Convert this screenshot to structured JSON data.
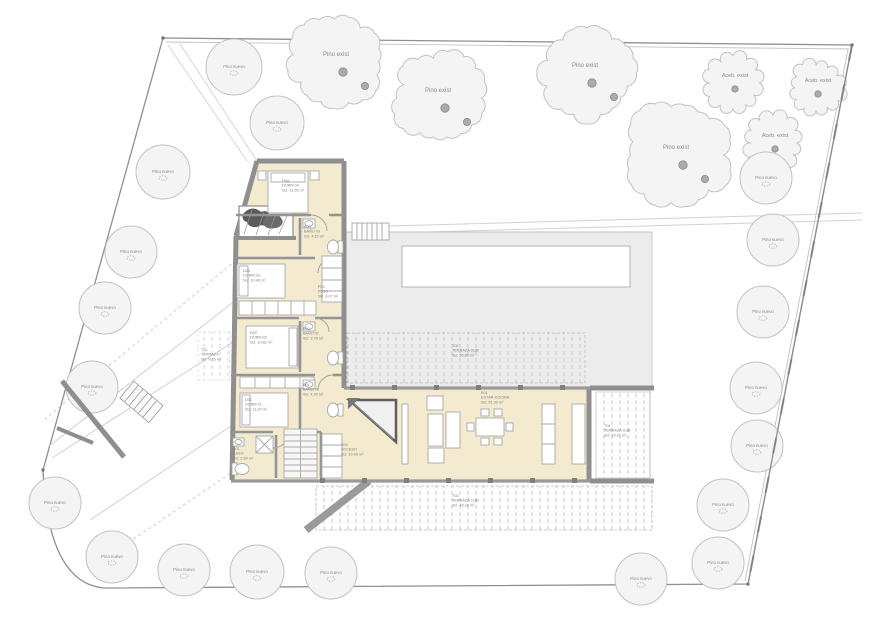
{
  "colors": {
    "room_fill": "#f3ead0",
    "wall": "#8f8f8f",
    "wall_light": "#9a9a9a",
    "deck_fill": "#ececec",
    "hatch": "#c6c6c6",
    "tree_fill": "#f4f4f4",
    "tree_stroke": "#c2c2c2",
    "trunk": "#ababab",
    "label": "#8a8a8a",
    "boundary": "#8f8f8f"
  },
  "trees": {
    "existing_pine_label": "Pino exist",
    "existing_holly_label": "Aceb. exist",
    "new_pine_label": "Pino nuevo",
    "existing_pines": [
      {
        "x": 338,
        "y": 62,
        "r": 50
      },
      {
        "x": 440,
        "y": 98,
        "r": 47
      },
      {
        "x": 587,
        "y": 73,
        "r": 51
      },
      {
        "x": 678,
        "y": 155,
        "r": 57
      }
    ],
    "existing_holly": [
      {
        "x": 733,
        "y": 83,
        "r": 28
      },
      {
        "x": 816,
        "y": 88,
        "r": 26
      },
      {
        "x": 773,
        "y": 143,
        "r": 27
      }
    ],
    "new_pines": [
      {
        "x": 234,
        "y": 67,
        "r": 28
      },
      {
        "x": 277,
        "y": 123,
        "r": 27
      },
      {
        "x": 163,
        "y": 172,
        "r": 27
      },
      {
        "x": 131,
        "y": 252,
        "r": 26
      },
      {
        "x": 105,
        "y": 308,
        "r": 26
      },
      {
        "x": 92,
        "y": 387,
        "r": 26
      },
      {
        "x": 55,
        "y": 503,
        "r": 26
      },
      {
        "x": 112,
        "y": 557,
        "r": 26
      },
      {
        "x": 184,
        "y": 570,
        "r": 26
      },
      {
        "x": 257,
        "y": 572,
        "r": 27
      },
      {
        "x": 331,
        "y": 573,
        "r": 26
      },
      {
        "x": 641,
        "y": 579,
        "r": 26
      },
      {
        "x": 718,
        "y": 563,
        "r": 26
      },
      {
        "x": 723,
        "y": 505,
        "r": 26
      },
      {
        "x": 757,
        "y": 446,
        "r": 26
      },
      {
        "x": 756,
        "y": 388,
        "r": 26
      },
      {
        "x": 763,
        "y": 312,
        "r": 26
      },
      {
        "x": 773,
        "y": 240,
        "r": 26
      },
      {
        "x": 766,
        "y": 178,
        "r": 26
      }
    ]
  },
  "rooms": [
    {
      "code": "D04",
      "name": "DORM.04",
      "area": "SU: 11.35 m²",
      "x": 282,
      "y": 182
    },
    {
      "code": "B03",
      "name": "BAÑO 03",
      "area": "SU: 4.15 m²",
      "x": 304,
      "y": 228
    },
    {
      "code": "P02",
      "name": "PASO",
      "area": "SU: 6.07 m²",
      "x": 318,
      "y": 288
    },
    {
      "code": "D03",
      "name": "DORM.03",
      "area": "SU: 10.46 m²",
      "x": 243,
      "y": 272
    },
    {
      "code": "D02",
      "name": "DORM.02",
      "area": "SU: 10.82 m²",
      "x": 250,
      "y": 334
    },
    {
      "code": "B02",
      "name": "BAÑO 02",
      "area": "SU: 3.76 m²",
      "x": 303,
      "y": 330
    },
    {
      "code": "D01",
      "name": "DORM.01",
      "area": "SU: 11.20 m²",
      "x": 245,
      "y": 401
    },
    {
      "code": "B01",
      "name": "BAÑO 01",
      "area": "SU: 4.20 m²",
      "x": 303,
      "y": 386
    },
    {
      "code": "A01",
      "name": "ASEO",
      "area": "SU: 2.84 m²",
      "x": 233,
      "y": 450
    },
    {
      "code": "E00",
      "name": "ACCESO",
      "area": "SU: 10.45 m²",
      "x": 341,
      "y": 446
    },
    {
      "code": "E01",
      "name": "ESTAR-COCINA",
      "area": "SU: 51.30 m²",
      "x": 481,
      "y": 394
    },
    {
      "code": "T01",
      "name": "TERRAZA",
      "area": "SU: 9.16 m²",
      "x": 201,
      "y": 351
    },
    {
      "code": "T02",
      "name": "TERRAZA CUB",
      "area": "SU: 35.60 m²",
      "x": 452,
      "y": 347
    },
    {
      "code": "T03",
      "name": "TERRAZA CUB",
      "area": "SU: 48.28 m²",
      "x": 452,
      "y": 497
    },
    {
      "code": "T04",
      "name": "TERRAZA CUB",
      "area": "SU: 16.21 m²",
      "x": 604,
      "y": 427
    }
  ]
}
